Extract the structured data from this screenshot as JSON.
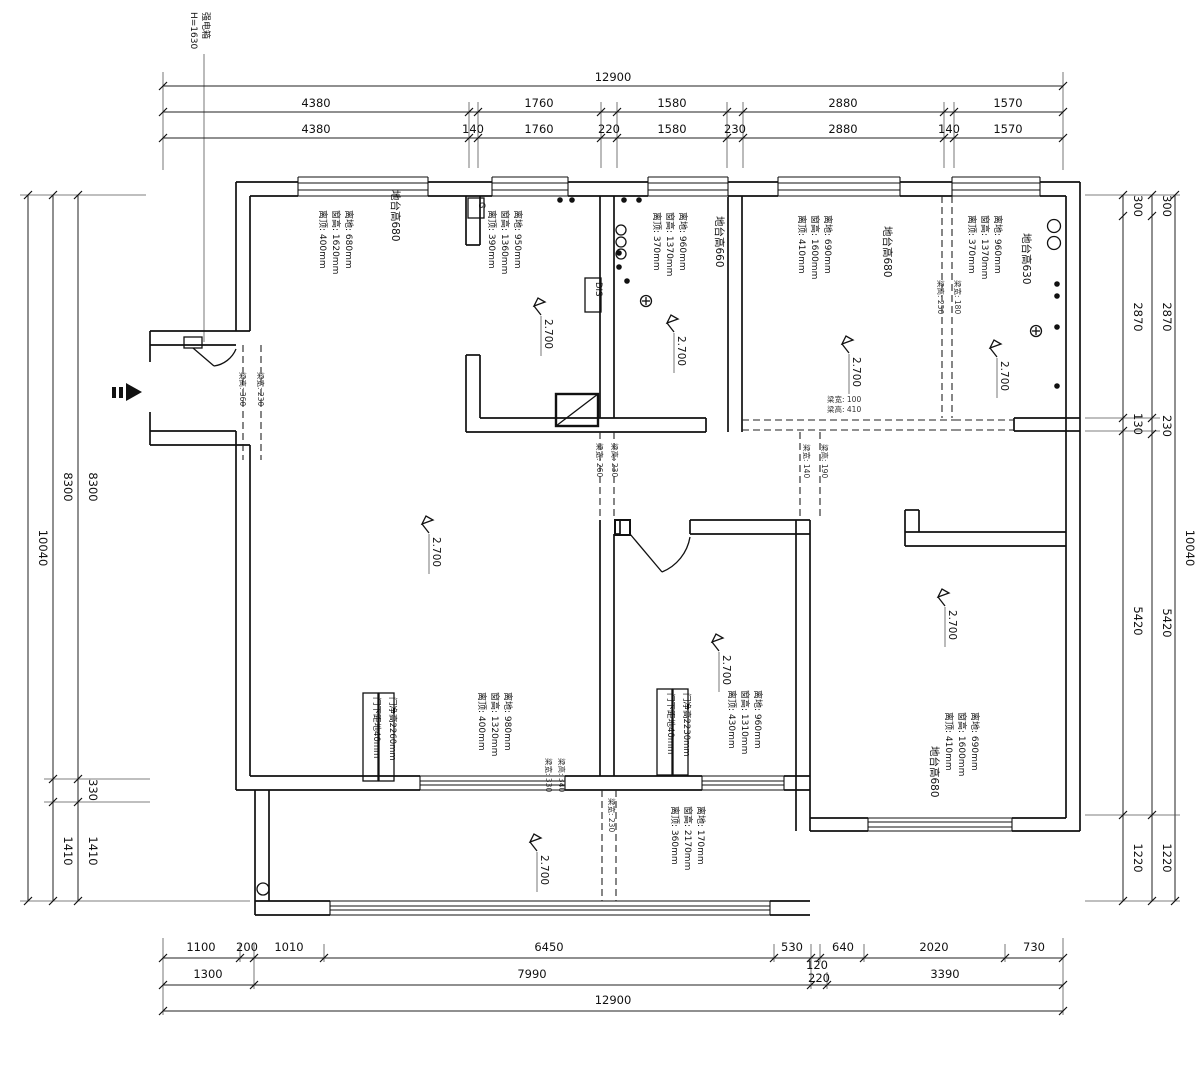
{
  "meta": {
    "strong_box_label": "强电箱",
    "strong_box_height": "H=1630"
  },
  "ceiling_height": "2.700",
  "dims": {
    "top": {
      "total": "12900",
      "segments": [
        "4380",
        "1760",
        "1580",
        "2880",
        "1570"
      ],
      "detail": [
        "4380",
        "140",
        "1760",
        "220",
        "1580",
        "230",
        "2880",
        "140",
        "1570"
      ]
    },
    "bottom": {
      "detail": [
        "1100",
        "200",
        "1010",
        "6450",
        "530",
        "120",
        "640",
        "2020",
        "730"
      ],
      "segments": [
        "1300",
        "7990",
        "220",
        "3390"
      ],
      "total": "12900"
    },
    "left": {
      "total": "10040",
      "mid": [
        "8300",
        "1410"
      ],
      "inner": [
        "8300",
        "330",
        "1410"
      ]
    },
    "right": {
      "inner": [
        "300",
        "2870",
        "130",
        "5420",
        "1220"
      ],
      "mid": [
        "300",
        "2870",
        "230",
        "5420",
        "1220"
      ],
      "total": "10040"
    }
  },
  "windows": {
    "w1": {
      "platform": "地台高680",
      "spec": [
        "离顶: 400mm",
        "窗高: 1620mm",
        "离地: 680mm"
      ]
    },
    "w2": {
      "spec": [
        "离顶: 390mm",
        "窗高: 1360mm",
        "离地: 950mm"
      ]
    },
    "w3": {
      "platform": "地台高660",
      "spec": [
        "离顶: 370mm",
        "窗高: 1370mm",
        "离地: 960mm"
      ]
    },
    "w4": {
      "platform": "地台高680",
      "spec": [
        "离顶: 410mm",
        "窗高: 1600mm",
        "离地: 690mm"
      ]
    },
    "w5": {
      "platform": "地台高630",
      "spec": [
        "离顶: 370mm",
        "窗高: 1370mm",
        "离地: 960mm"
      ]
    },
    "w6": {
      "spec": [
        "离顶: 400mm",
        "窗高: 1320mm",
        "离地: 980mm"
      ]
    },
    "w7": {
      "spec": [
        "离顶: 430mm",
        "窗高: 1310mm",
        "离地: 960mm"
      ]
    },
    "w8": {
      "spec": [
        "离顶: 360mm",
        "窗高: 2170mm",
        "离地: 170mm"
      ]
    },
    "w9": {
      "platform": "地台高680",
      "spec": [
        "离顶: 410mm",
        "窗高: 1600mm",
        "离地: 690mm"
      ]
    }
  },
  "doors": {
    "d1": {
      "clear": "门净高2260mm",
      "bottom": "门下距地40mm"
    },
    "d2": {
      "clear": "门净高2230mm",
      "bottom": "门下距地40mm"
    }
  },
  "beams": {
    "entry": [
      "梁高: 360",
      "梁宽: 230"
    ],
    "corridor": [
      "梁宽: 260",
      "梁高: 230"
    ],
    "r34": [
      "梁高: 250",
      "梁宽: 180"
    ],
    "r3_bottom": [
      "梁宽: 100",
      "梁高: 410"
    ],
    "hall_right": [
      "梁宽: 140",
      "梁高: 190"
    ],
    "left_bottom": [
      "梁宽: 330",
      "梁高: 340"
    ],
    "balcony": "梁宽: 230"
  },
  "labels": {
    "dis": "DIS",
    "gas": "G"
  }
}
